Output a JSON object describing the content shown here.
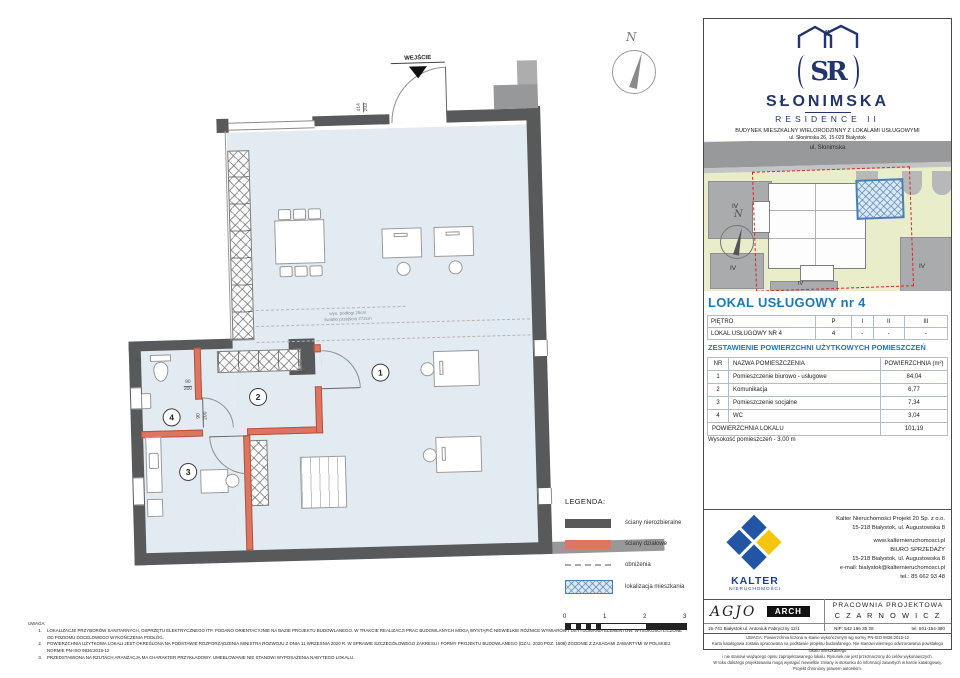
{
  "colors": {
    "accent_blue": "#1a7abf",
    "brand_navy": "#23356d",
    "wall_gray": "#58595b",
    "partition_red": "#de7560",
    "floor_blue": "#e2ebf2",
    "location_hatch_blue": "#4a7fb5",
    "map_green": "#e9edca",
    "boundary_red": "#e02424",
    "kalter_blue": "#2256a5",
    "kalter_yellow": "#f6c60e"
  },
  "plan": {
    "entrance_label": "WEJŚCIE",
    "north_label": "N",
    "floor_note_line1": "wys. podłogi 26cm",
    "floor_note_line2": "światło przejścia 272cm",
    "rooms": [
      {
        "number": "1"
      },
      {
        "number": "2"
      },
      {
        "number": "3"
      },
      {
        "number": "4"
      }
    ],
    "dims": {
      "entrance_top": "414",
      "entrance_bottom": "203",
      "door_top": "90",
      "door_bottom": "200"
    }
  },
  "legend": {
    "title": "LEGENDA:",
    "items": [
      {
        "label": "ściany nierozbieralne"
      },
      {
        "label": "ściany działowe"
      },
      {
        "label": "obniżenia"
      },
      {
        "label": "lokalizacja mieszkania"
      }
    ],
    "scale_ticks": [
      "0",
      "1",
      "2",
      "3"
    ]
  },
  "notes": {
    "title": "UWAGA:",
    "items": [
      "LOKALIZACJE PRZYBORÓW SANITARNYCH, OSPRZĘTU ELEKTRYCZNEGO ITP. PODANO ORIENTACYJNIE NA BAZIE PROJEKTU BUDOWLANEGO. W TRAKCIE REALIZACJI PRAC BUDOWLANYCH MOGĄ WYSTĄPIĆ NIEWIELKIE RÓŻNICE WYMIARÓW I USYTUOWANIA ELEMENTÓW. WYSOKOŚCI LICZONE OD POZIOMU DOCELOWEGO WYKOŃCZENIA PODŁÓG.",
      "POWIERZCHNIA UŻYTKOWA LOKALI JEST OKREŚLONA NA PODSTAWIE ROZPORZĄDZENIA MINISTRA ROZWOJU Z DNIA 11 WRZEŚNIA 2020 R. W SPRAWIE SZCZEGÓŁOWEGO ZAKRESU I FORMY PROJEKTU BUDOWLANEGO (DZ.U. 2020 POZ. 1609) ZGODNIE Z ZASADAMI ZAWARTYMI W POLSKIEJ NORMIE PN-ISO 9836:2015-12",
      "PRZEDSTAWIONA NA RZUTACH ARANŻACJA MA CHARAKTER PRZYKŁADOWY. UMEBLOWANIE NIE STANOWI WYPOSAŻENIA NABYTEGO LOKALU."
    ]
  },
  "panel": {
    "logo": {
      "monogram": "SR",
      "roof_numeral": "II",
      "brand": "SŁONIMSKA",
      "brand2": "RESIDENCE II",
      "desc1": "BUDYNEK MIESZKALNY WIELORODZINNY Z LOKALAMI USŁUGOWYMI",
      "desc2": "ul. Słonimska 26, 15-029 Białystok"
    },
    "map": {
      "street": "ul. Słonimska",
      "north": "N",
      "block_labels": [
        "IV",
        "IV",
        "IV",
        "IV"
      ]
    },
    "unit_title": "LOKAL USŁUGOWY  nr 4",
    "floor_table": {
      "rows": [
        [
          "PIĘTRO",
          "P",
          "I",
          "II",
          "III"
        ],
        [
          "LOKAL USŁUGOWY NR 4",
          "4",
          "-",
          "-",
          "-"
        ]
      ]
    },
    "areas_title": "ZESTAWIENIE POWIERZCHNI UŻYTKOWYCH POMIESZCZEŃ",
    "areas_table": {
      "col_nr": "NR",
      "col_name": "NAZWA POMIESZCZENIA",
      "col_area": "POWIERZCHNIA (m²)",
      "rows": [
        {
          "nr": "1",
          "name": "Pomieszczenie biurowo - usługowe",
          "area": "84,04"
        },
        {
          "nr": "2",
          "name": "Komunikacja",
          "area": "6,77"
        },
        {
          "nr": "3",
          "name": "Pomieszczenie socjalne",
          "area": "7,34"
        },
        {
          "nr": "4",
          "name": "WC",
          "area": "3,04"
        }
      ],
      "total_label": "POWIERZCHNIA LOKALU",
      "total_value": "101,19"
    },
    "height_note": "Wysokość pomieszczeń - 3,00 m",
    "kalter": {
      "brand": "KALTER",
      "brand_sub": "NIERUCHOMOŚCI",
      "lines": [
        "Kalter Nieruchomości Projekt 20  Sp. z o.o.",
        "15-218 Białystok, ul. Augustowska 8",
        "www.kalternieruchomosci.pl",
        "BIURO SPRZEDAŻY",
        "15-218 Białystok, ul. Augustowska 8",
        "e-mail: bialystok@kalternieruchomosci.pl",
        "tel.: 85 662 93 48"
      ]
    },
    "studio": {
      "agjo": "AGJO",
      "arch": "ARCH",
      "address": "15-741 Białystok    ul. Antoniuk Fabryczny  12/1",
      "name1": "PRACOWNIA PROJEKTOWA",
      "name2": "C Z A R N O W I C Z",
      "nip": "NIP:  542 166 35 28",
      "tel": "tel. 501-154-380"
    },
    "fine_print": [
      "UWAGA:  Powierzchnia liczona w stanie wykończonym wg normy PN-ISO 9836:2015-12",
      "Karta katalogowa została opracowana na podstawie projektu budowlanego.  Nie stanowi wiernego odwzorowania powstałego lokalu mieszkalnego",
      "i nie stanowi wiążącego opisu zaprojektowanego lokalu. Rysunek nie jest przeznaczony do celów wykonawczych.",
      "W toku dalszego projektowania mogą wystąpić niewielkie zmiany w stosunku do informacji zawartych w karcie katalogowej. Projekt chroniony prawem autorskim."
    ]
  }
}
